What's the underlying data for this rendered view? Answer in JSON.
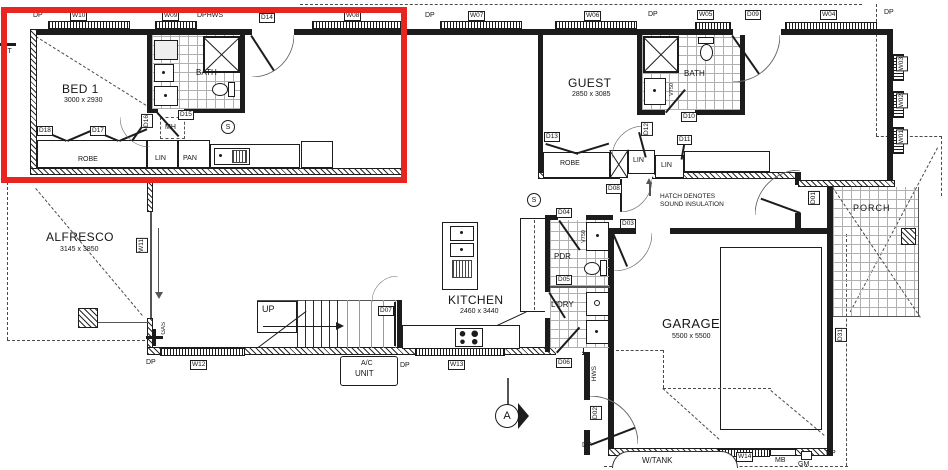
{
  "annotation": {
    "highlight_color": "#e8251f"
  },
  "rooms": {
    "bed1": {
      "name": "BED 1",
      "dims": "3000 x 2930"
    },
    "bath1": {
      "name": "BATH"
    },
    "guest": {
      "name": "GUEST",
      "dims": "2850 x 3085"
    },
    "bath2": {
      "name": "BATH"
    },
    "alfresco": {
      "name": "ALFRESCO",
      "dims": "3145 x 3850"
    },
    "kitchen": {
      "name": "KITCHEN",
      "dims": "2460 x 3440"
    },
    "garage": {
      "name": "GARAGE",
      "dims": "5500 x 5500"
    },
    "porch": {
      "name": "PORCH"
    },
    "pdr": {
      "name": "PDR"
    },
    "ldry": {
      "name": "L'DRY"
    }
  },
  "storage": {
    "robe1": "ROBE",
    "lin1": "LIN",
    "pan1": "PAN",
    "robe2": "ROBE",
    "lin2": "LIN",
    "lin3": "LIN"
  },
  "doors": {
    "d01": "D01",
    "d02": "D02",
    "d03": "D03",
    "d04": "D04",
    "d05": "D05",
    "d06": "D06",
    "d07": "D07",
    "d08": "D08",
    "d09": "D09",
    "d10": "D10",
    "d11": "D11",
    "d12": "D12",
    "d13": "D13",
    "d14": "D14",
    "d15": "D15",
    "d16": "D16",
    "d17": "D17",
    "d18": "D18",
    "d31": "D31"
  },
  "windows": {
    "w01": "W01",
    "w02": "W02",
    "w03": "W03",
    "w04": "W04",
    "w05": "W05",
    "w06": "W06",
    "w07": "W07",
    "w08": "W08",
    "w09": "W09",
    "w10": "W10",
    "w11": "W11",
    "w12": "W12",
    "w13": "W13",
    "w14": "W14"
  },
  "services": {
    "dp": "DP",
    "dphws": "DPHWS",
    "gt": "GT",
    "gas": "GAS",
    "hws": "HWS",
    "mb": "MB",
    "gm": "GM",
    "wtank": "W/TANK",
    "mh": "MH",
    "ac1": "A/C",
    "ac2": "UNIT",
    "v750": "V750"
  },
  "stairs": {
    "up": "UP"
  },
  "notes": {
    "hatch1": "HATCH DENOTES",
    "hatch2": "SOUND INSULATION"
  },
  "markers": {
    "section": "A",
    "smoke": "S"
  }
}
